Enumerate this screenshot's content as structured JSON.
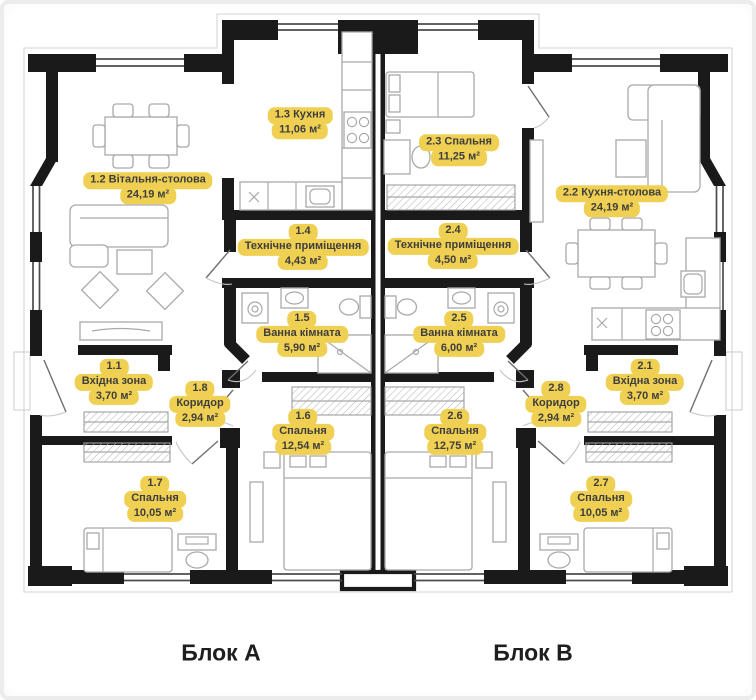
{
  "colors": {
    "label_bg": "#efd052",
    "label_text": "#3e3e3e",
    "wall": "#1a1a1a",
    "furniture_line": "#a9a9a9",
    "window_line": "#4b4b4b"
  },
  "footer": {
    "block_a": "Блок А",
    "block_b": "Блок В"
  },
  "rooms": {
    "r11": {
      "lines": [
        "1.1",
        "Вхідна зона",
        "3,70 м²"
      ]
    },
    "r12": {
      "lines": [
        "1.2 Вітальня-столова",
        "24,19 м²"
      ]
    },
    "r13": {
      "lines": [
        "1.3 Кухня",
        "11,06 м²"
      ]
    },
    "r14": {
      "lines": [
        "1.4",
        "Технічне приміщення",
        "4,43 м²"
      ]
    },
    "r15": {
      "lines": [
        "1.5",
        "Ванна кімната",
        "5,90 м²"
      ]
    },
    "r16": {
      "lines": [
        "1.6",
        "Спальня",
        "12,54 м²"
      ]
    },
    "r17": {
      "lines": [
        "1.7",
        "Спальня",
        "10,05 м²"
      ]
    },
    "r18": {
      "lines": [
        "1.8",
        "Коридор",
        "2,94 м²"
      ]
    },
    "r21": {
      "lines": [
        "2.1",
        "Вхідна зона",
        "3,70 м²"
      ]
    },
    "r22": {
      "lines": [
        "2.2 Кухня-столова",
        "24,19 м²"
      ]
    },
    "r23": {
      "lines": [
        "2.3 Спальня",
        "11,25 м²"
      ]
    },
    "r24": {
      "lines": [
        "2.4",
        "Технічне приміщення",
        "4,50 м²"
      ]
    },
    "r25": {
      "lines": [
        "2.5",
        "Ванна кімната",
        "6,00 м²"
      ]
    },
    "r26": {
      "lines": [
        "2.6",
        "Спальня",
        "12,75 м²"
      ]
    },
    "r27": {
      "lines": [
        "2.7",
        "Спальня",
        "10,05 м²"
      ]
    },
    "r28": {
      "lines": [
        "2.8",
        "Коридор",
        "2,94 м²"
      ]
    }
  }
}
